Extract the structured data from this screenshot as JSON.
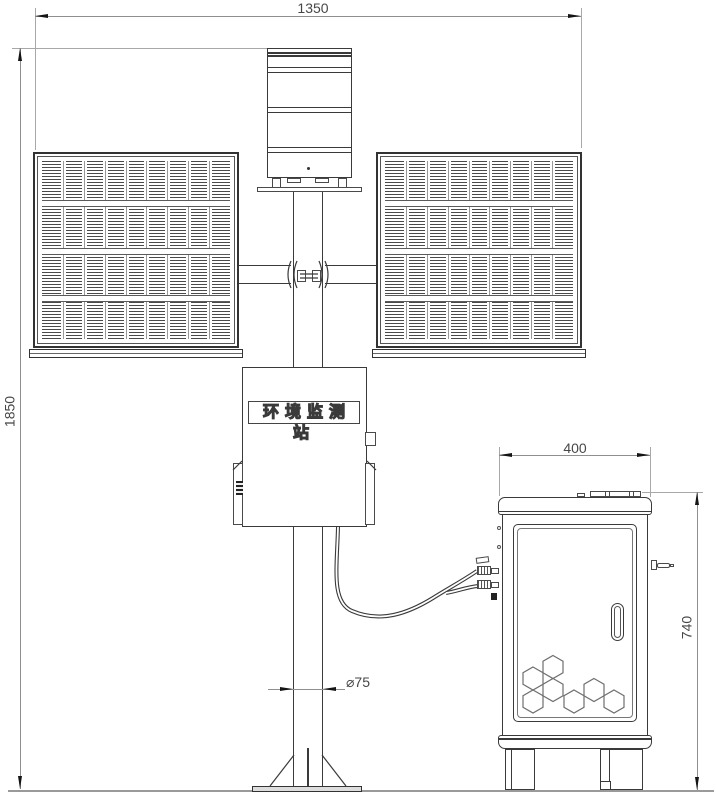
{
  "meta": {
    "background": "#ffffff",
    "line_color": "#3a3a3a",
    "dim_line_color": "#8f8f8f",
    "dim_text_color": "#474747"
  },
  "annotations": {
    "top_width": "1350",
    "total_height": "1850",
    "cabinet_width": "400",
    "cabinet_height": "740",
    "pole_diameter": "⌀75"
  },
  "station_box": {
    "label": "环境监测站"
  }
}
